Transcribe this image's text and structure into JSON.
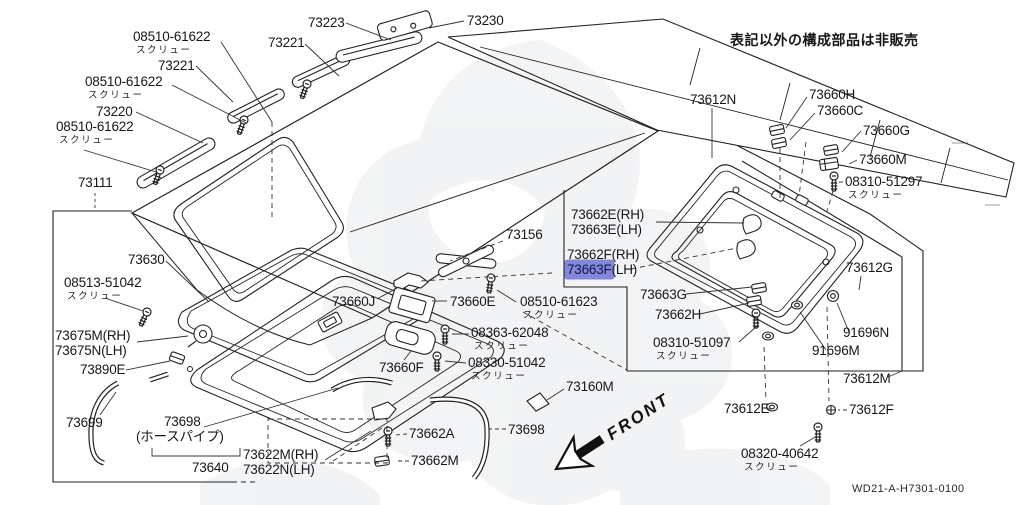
{
  "meta": {
    "note_jp": "表記以外の構成部品は非販売",
    "drawing_no": "WD21-A-H7301-0100"
  },
  "front": {
    "label": "FRONT"
  },
  "highlight": {
    "color": "#8387d9",
    "highlighted_part": "73663F"
  },
  "labels": [
    {
      "t": "08510-61622",
      "sub": "スクリュー",
      "x": 133,
      "y": 30
    },
    {
      "t": "73221",
      "x": 158,
      "y": 59
    },
    {
      "t": "08510-61622",
      "sub": "スクリュー",
      "x": 85,
      "y": 75
    },
    {
      "t": "73220",
      "x": 96,
      "y": 105
    },
    {
      "t": "08510-61622",
      "sub": "スクリュー",
      "x": 56,
      "y": 120
    },
    {
      "t": "73111",
      "x": 78,
      "y": 176
    },
    {
      "t": "73223",
      "x": 308,
      "y": 16
    },
    {
      "t": "73221",
      "x": 268,
      "y": 36
    },
    {
      "t": "73230",
      "x": 467,
      "y": 14
    },
    {
      "t": "73612N",
      "x": 690,
      "y": 93
    },
    {
      "t": "73660H",
      "x": 809,
      "y": 88
    },
    {
      "t": "73660C",
      "x": 817,
      "y": 104
    },
    {
      "t": "73660G",
      "x": 863,
      "y": 124
    },
    {
      "t": "73660M",
      "x": 859,
      "y": 153
    },
    {
      "t": "08310-51297",
      "sub": "スクリュー",
      "x": 845,
      "y": 175
    },
    {
      "t": "73662E(RH)",
      "x": 571,
      "y": 208
    },
    {
      "t": "73663E(LH)",
      "x": 571,
      "y": 223
    },
    {
      "t": "73662F(RH)",
      "x": 567,
      "y": 248
    },
    {
      "hl_text": "73663F",
      "rest_text": "(LH)",
      "x": 567,
      "y": 263
    },
    {
      "t": "73612G",
      "x": 846,
      "y": 261
    },
    {
      "t": "73663G",
      "x": 640,
      "y": 288
    },
    {
      "t": "73662H",
      "x": 655,
      "y": 308
    },
    {
      "t": "08310-51097",
      "sub": "スクリュー",
      "x": 653,
      "y": 336
    },
    {
      "t": "91696N",
      "x": 843,
      "y": 326
    },
    {
      "t": "91696M",
      "x": 812,
      "y": 344
    },
    {
      "t": "73612M",
      "x": 843,
      "y": 372
    },
    {
      "t": "73612E",
      "x": 724,
      "y": 402
    },
    {
      "t": "73612F",
      "x": 849,
      "y": 403
    },
    {
      "t": "08320-40642",
      "sub": "スクリュー",
      "x": 741,
      "y": 447
    },
    {
      "t": "73156",
      "x": 506,
      "y": 228
    },
    {
      "t": "73660J",
      "x": 332,
      "y": 295
    },
    {
      "t": "73660E",
      "x": 450,
      "y": 295
    },
    {
      "t": "08510-61623",
      "sub": "スクリュー",
      "x": 520,
      "y": 295
    },
    {
      "t": "08363-62048",
      "sub": "スクリュー",
      "x": 471,
      "y": 326
    },
    {
      "t": "08330-51042",
      "sub": "スクリュー",
      "x": 468,
      "y": 356
    },
    {
      "t": "73660F",
      "x": 379,
      "y": 361
    },
    {
      "t": "73160M",
      "x": 566,
      "y": 380
    },
    {
      "t": "73630",
      "x": 128,
      "y": 253
    },
    {
      "t": "08513-51042",
      "sub": "スクリュー",
      "x": 64,
      "y": 276
    },
    {
      "t": "73675M(RH)",
      "x": 55,
      "y": 329
    },
    {
      "t": "73675N(LH)",
      "x": 55,
      "y": 344
    },
    {
      "t": "73890E",
      "x": 80,
      "y": 363
    },
    {
      "t": "73699",
      "x": 66,
      "y": 416
    },
    {
      "t": "73698",
      "x": 164,
      "y": 415
    },
    {
      "t": "(ホースパイプ)",
      "x": 136,
      "y": 430
    },
    {
      "t": "73640",
      "x": 192,
      "y": 461
    },
    {
      "t": "73622M(RH)",
      "x": 243,
      "y": 448
    },
    {
      "t": "73622N(LH)",
      "x": 243,
      "y": 463
    },
    {
      "t": "73662A",
      "x": 409,
      "y": 427
    },
    {
      "t": "73662M",
      "x": 411,
      "y": 454
    },
    {
      "t": "73698",
      "x": 508,
      "y": 423
    }
  ]
}
